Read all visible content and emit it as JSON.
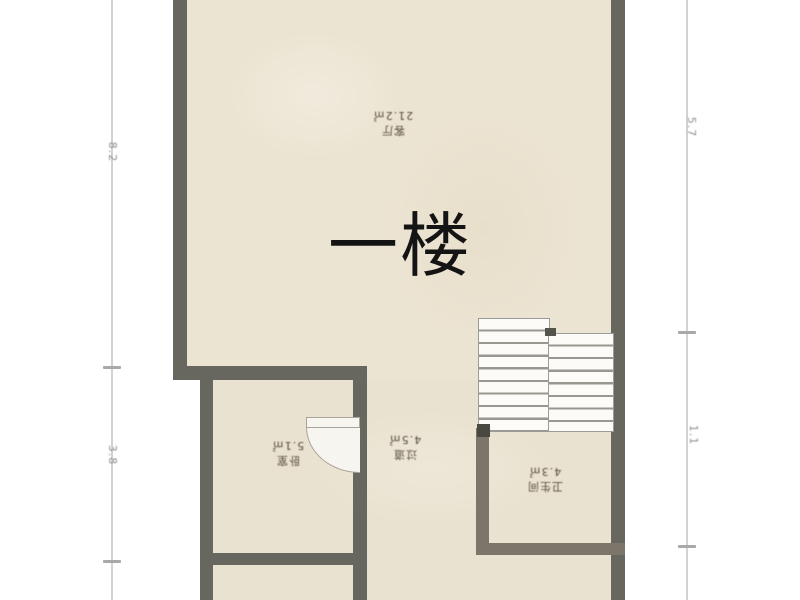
{
  "title": "一楼",
  "rooms": {
    "living": {
      "name": "客厅",
      "area": "21.2㎡"
    },
    "bedroom": {
      "name": "卧室",
      "area": "5.1㎡"
    },
    "hallway": {
      "name": "过道",
      "area": "4.5㎡"
    },
    "bathroom": {
      "name": "卫生间",
      "area": "4.3㎡"
    }
  },
  "dimensions": {
    "left": [
      "8.2",
      "3.8"
    ],
    "right": [
      "5.7",
      "1.1"
    ]
  },
  "colors": {
    "room_fill": "#ece4d2",
    "wall": "#68675f",
    "wall_inner": "#7c756a",
    "dimension_line": "#d2d2d2",
    "title_color": "#141414"
  }
}
